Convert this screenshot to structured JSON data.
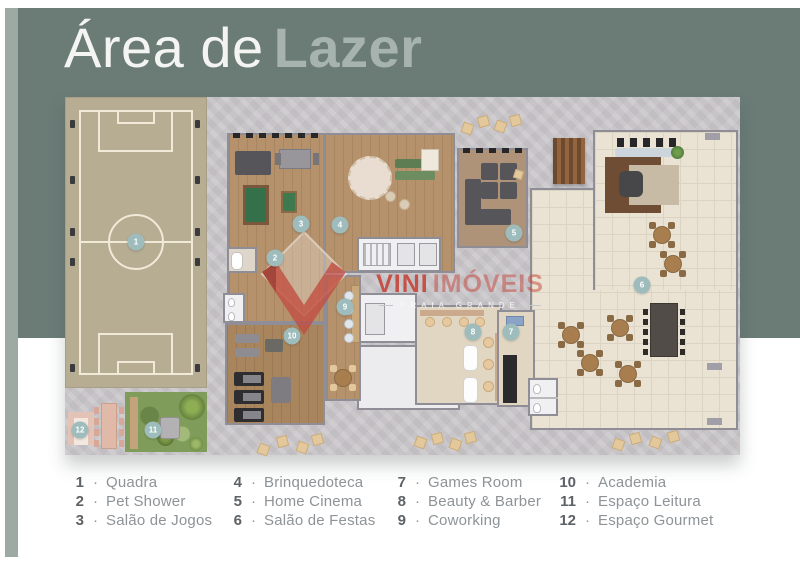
{
  "title": {
    "prefix": "Área de",
    "emphasis": "Lazer"
  },
  "watermark": {
    "brand_primary": "VINI",
    "brand_secondary": "IMÓVEIS",
    "tagline": "PRAIA GRANDE"
  },
  "legend": {
    "separator": "·",
    "columns": [
      [
        {
          "num": "1",
          "label": "Quadra"
        },
        {
          "num": "2",
          "label": "Pet Shower"
        },
        {
          "num": "3",
          "label": "Salão de Jogos"
        }
      ],
      [
        {
          "num": "4",
          "label": "Brinquedoteca"
        },
        {
          "num": "5",
          "label": "Home Cinema"
        },
        {
          "num": "6",
          "label": "Salão de Festas"
        }
      ],
      [
        {
          "num": "7",
          "label": "Games Room"
        },
        {
          "num": "8",
          "label": "Beauty & Barber"
        },
        {
          "num": "9",
          "label": "Coworking"
        }
      ],
      [
        {
          "num": "10",
          "label": "Academia"
        },
        {
          "num": "11",
          "label": "Espaço Leitura"
        },
        {
          "num": "12",
          "label": "Espaço Gourmet"
        }
      ]
    ]
  },
  "plan_markers": [
    {
      "num": "1",
      "area": "quadra",
      "x": 71,
      "y": 145
    },
    {
      "num": "2",
      "area": "pet-shower",
      "x": 210,
      "y": 161
    },
    {
      "num": "3",
      "area": "salao-de-jogos",
      "x": 236,
      "y": 127
    },
    {
      "num": "4",
      "area": "brinquedoteca",
      "x": 275,
      "y": 128
    },
    {
      "num": "5",
      "area": "home-cinema",
      "x": 449,
      "y": 136
    },
    {
      "num": "6",
      "area": "salao-de-festas",
      "x": 577,
      "y": 188
    },
    {
      "num": "7",
      "area": "games-room",
      "x": 446,
      "y": 235
    },
    {
      "num": "8",
      "area": "beauty-barber",
      "x": 408,
      "y": 235
    },
    {
      "num": "9",
      "area": "coworking",
      "x": 280,
      "y": 210
    },
    {
      "num": "10",
      "area": "academia",
      "x": 227,
      "y": 239
    },
    {
      "num": "11",
      "area": "espaco-leitura",
      "x": 88,
      "y": 333
    },
    {
      "num": "12",
      "area": "espaco-gourmet",
      "x": 15,
      "y": 333
    }
  ],
  "colors": {
    "sage_panel": "#6b7c77",
    "sage_bar": "#9daaa4",
    "title_emphasis": "#a7b3af",
    "title_prefix": "#f4f5f2",
    "concrete": "#c9c6ca",
    "marker_teal": "#9fbcbd",
    "accent_red": "#c5463c",
    "legend_number": "#5d6266",
    "legend_label": "#8e9397",
    "court_beige": "#b6ad93",
    "wood_floor": "#b5916c",
    "tile_floor": "#eae3d3",
    "grass_green": "#7f9c5a"
  }
}
